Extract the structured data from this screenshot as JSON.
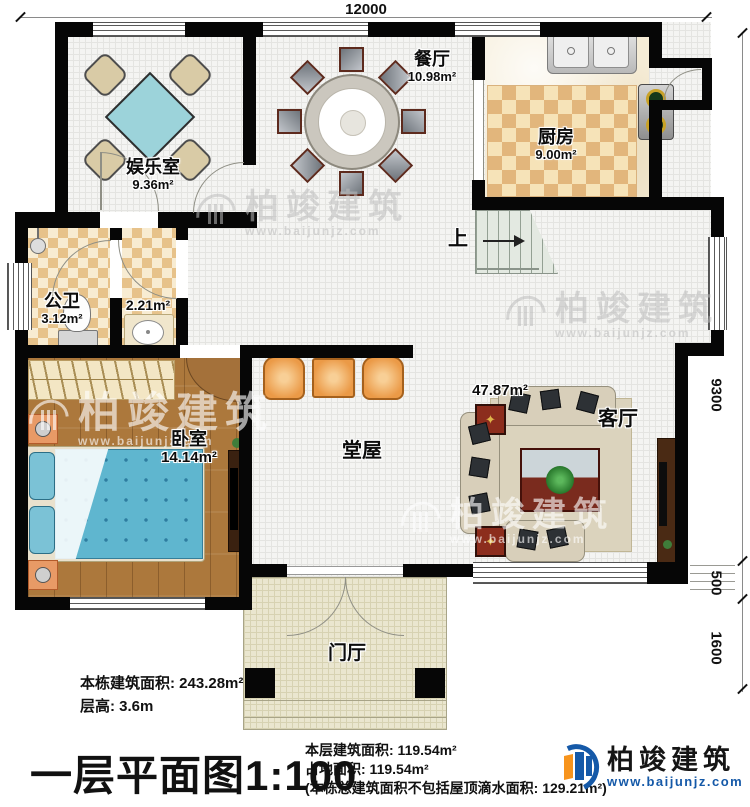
{
  "dims": {
    "top": "12000",
    "right_1": "9300",
    "right_2": "500",
    "right_3": "1600"
  },
  "rooms": {
    "entertainment": {
      "name": "娱乐室",
      "area": "9.36m²"
    },
    "dining": {
      "name": "餐厅",
      "area": "10.98m²"
    },
    "kitchen": {
      "name": "厨房",
      "area": "9.00m²"
    },
    "bathroom": {
      "name": "公卫",
      "area": "3.12m²"
    },
    "vanity": {
      "area": "2.21m²"
    },
    "bedroom": {
      "name": "卧室",
      "area": "14.14m²"
    },
    "hall": {
      "name": "堂屋"
    },
    "living": {
      "name": "客厅",
      "area": "47.87m²"
    },
    "entry": {
      "name": "门厅"
    },
    "stairs": {
      "label": "上"
    }
  },
  "annotations": {
    "building_area": "本栋建筑面积: 243.28m²",
    "floor_height": "层高: 3.6m",
    "plan_title": "一层平面图1:100",
    "floor_area": "本层建筑面积: 119.54m²",
    "footprint_area": "占地面积: 119.54m²",
    "drip_note": "(本栋总建筑面积不包括屋顶滴水面积: 129.21m²)"
  },
  "brand": {
    "name": "柏竣建筑",
    "website": "www.baijunjz.com"
  },
  "watermark": {
    "name": "柏竣建筑",
    "website": "www.baijunjz.com"
  },
  "icons": {
    "table_star": "✦"
  },
  "colors": {
    "wall": "#060606",
    "brand_blue": "#1559a8",
    "brand_orange": "#f7941d",
    "bed_blue": "#5fb6cf",
    "game_table_teal": "#9cd3da",
    "stool_orange": "#eb9a47",
    "wood_floor": "#ac783c",
    "kitchen_tile": "#e2b67c"
  }
}
